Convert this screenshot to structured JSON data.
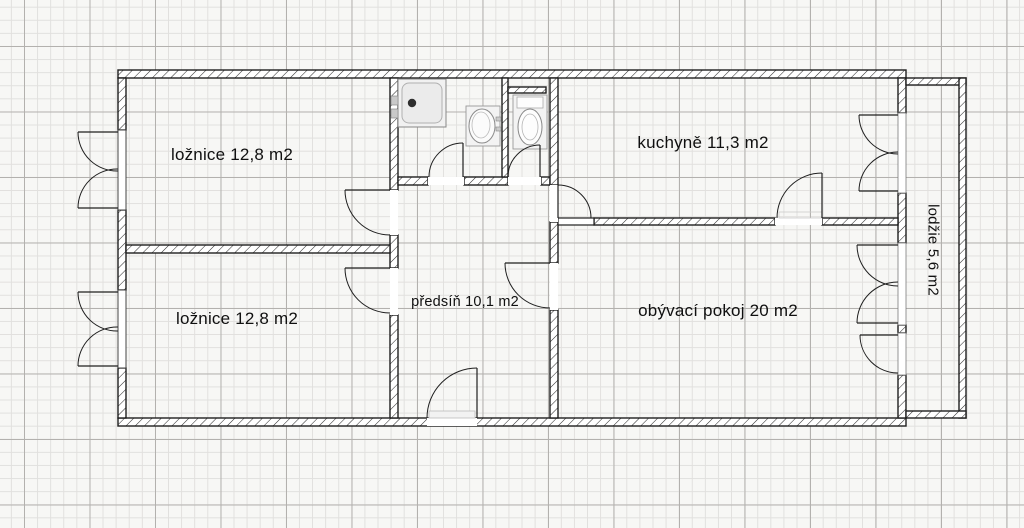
{
  "title": "Apartment floor plan",
  "rooms": [
    {
      "name": "bedroom-1",
      "label": "ložnice 12,8 m2"
    },
    {
      "name": "bedroom-2",
      "label": "ložnice 12,8 m2"
    },
    {
      "name": "kitchen",
      "label": "kuchyně 11,3 m2"
    },
    {
      "name": "hallway",
      "label": "předsíň 10,1 m2"
    },
    {
      "name": "living-room",
      "label": "obývací pokoj 20 m2"
    },
    {
      "name": "loggia",
      "label": "lodžie 5,6 m2"
    }
  ],
  "fixtures": [
    {
      "name": "shower-tray-icon"
    },
    {
      "name": "washbasin-icon"
    },
    {
      "name": "toilet-icon"
    }
  ],
  "colors": {
    "wall_line": "#1f1f1f",
    "paper": "#f7f7f5",
    "grid_minor": "#e1e0de",
    "grid_major": "#b3b1ae"
  }
}
